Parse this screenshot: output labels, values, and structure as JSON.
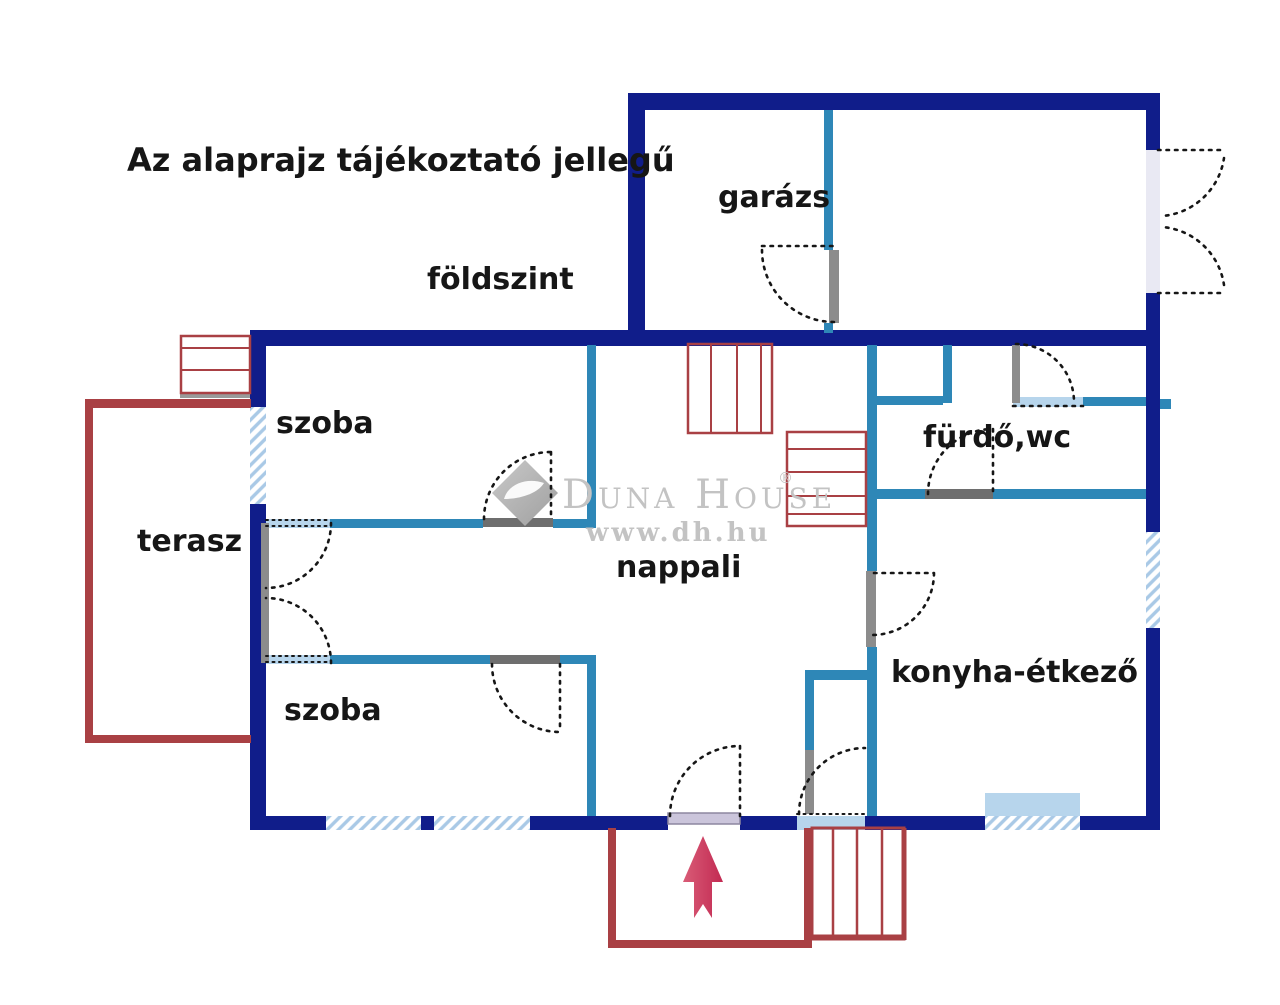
{
  "header": {
    "disclaimer": "Az alaprajz tájékoztató jellegű",
    "floor": "földszint"
  },
  "rooms": {
    "garage": "garázs",
    "room_top": "szoba",
    "terrace": "terasz",
    "living": "nappali",
    "bathroom": "fürdő,wc",
    "room_bottom": "szoba",
    "kitchen": "konyha-étkező"
  },
  "watermark": {
    "brand": "Duna House",
    "registered": "®",
    "url": "www.dh.hu"
  },
  "icons": {
    "entrance_arrow": "up-arrow"
  },
  "colors": {
    "c-navy": "#101d8a",
    "c-teal": "#2e87b7",
    "c-sill": "#b7d5ec",
    "c-hatch": "#a9c9e6",
    "c-red": "#a94044",
    "c-arrow1": "#d95c77",
    "c-arrow2": "#c22a52",
    "c-door": "#8c8c8c",
    "c-thresh": "#6e6e6e",
    "c-frontsill": "#cbc5db",
    "c-wm": "#c3c3c3",
    "c-ink": "#161616"
  }
}
